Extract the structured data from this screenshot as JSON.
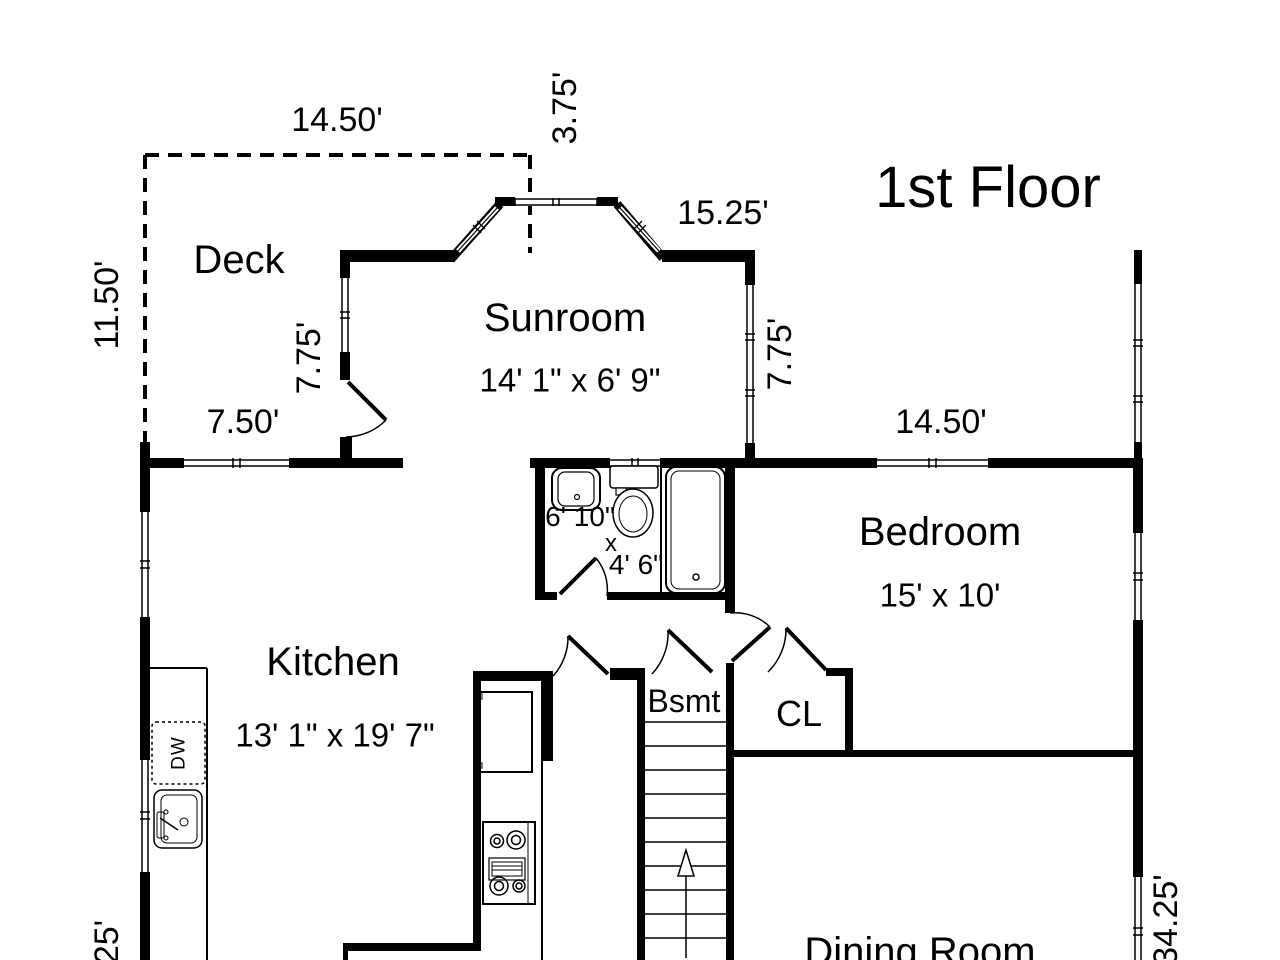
{
  "title": "1st Floor",
  "rooms": {
    "deck": {
      "label": "Deck"
    },
    "sunroom": {
      "label": "Sunroom",
      "size": "14' 1\" x 6' 9\""
    },
    "kitchen": {
      "label": "Kitchen",
      "size": "13' 1\" x 19' 7\""
    },
    "bedroom": {
      "label": "Bedroom",
      "size": "15' x 10'"
    },
    "bathroom": {
      "width": "6' 10\"",
      "times": "x",
      "depth": "4' 6\""
    },
    "basement_stairs": {
      "label": "Bsmt"
    },
    "closet": {
      "label": "CL"
    },
    "dining_room": {
      "label": "Dining Room"
    }
  },
  "fixtures": {
    "dishwasher": "DW"
  },
  "dimensions": {
    "deck_top": "14.50'",
    "deck_left": "11.50'",
    "deck_bottom": "7.50'",
    "bay_depth": "3.75'",
    "sunroom_width": "15.25'",
    "sunroom_left": "7.75'",
    "sunroom_right": "7.75'",
    "bedroom_top": "14.50'",
    "right_side": "34.25'",
    "left_bottom": "25'"
  },
  "colors": {
    "wall": "#000000",
    "background": "#ffffff"
  }
}
